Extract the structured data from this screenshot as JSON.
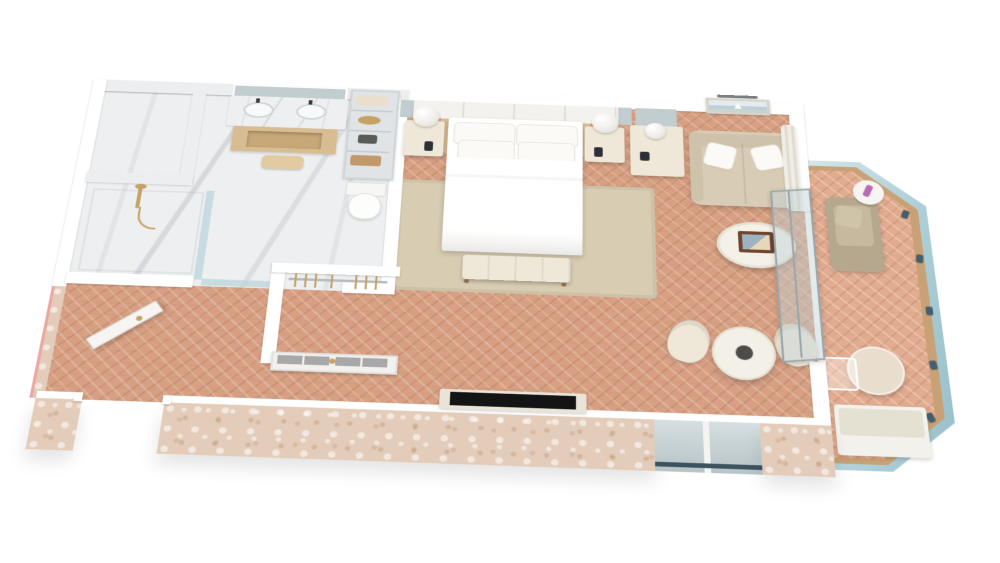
{
  "scene": {
    "type": "isometric-3d-floorplan-render",
    "description": "3D cutaway floor plan render of a hotel suite with marble bathroom, bedroom, lounge area and curved glass balcony",
    "background": "#ffffff",
    "rooms": [
      {
        "id": "bathroom",
        "name": "bathroom"
      },
      {
        "id": "walk-in-shower",
        "name": "walk-in shower"
      },
      {
        "id": "water-closet",
        "name": "water closet"
      },
      {
        "id": "wardrobe",
        "name": "wardrobe closet"
      },
      {
        "id": "entry-hall",
        "name": "entry hallway"
      },
      {
        "id": "bedroom",
        "name": "bedroom"
      },
      {
        "id": "lounge",
        "name": "lounge area"
      },
      {
        "id": "balcony",
        "name": "balcony"
      }
    ],
    "furniture": [
      "king-bed",
      "pillows",
      "bed-bench",
      "nightstand",
      "globe-lamp",
      "area-rug",
      "double-vanity",
      "vanity-mirror",
      "linen-shelves",
      "toilet",
      "hand-shower",
      "wardrobe-doors",
      "tv",
      "desk-console",
      "desk-mirror",
      "loveseat-sofa",
      "seascape-artwork",
      "picture-light",
      "coffee-table",
      "dining-table",
      "tub-chair",
      "sliding-glass-door",
      "curtain",
      "balcony-armchair",
      "balcony-side-table",
      "balcony-marble-table",
      "balcony-settee",
      "glass-balustrade",
      "entry-door"
    ]
  },
  "palette": {
    "wood_floor": "#d7a083",
    "marble": "#edeff0",
    "travertine": "#e3ccb9",
    "wall_cap": "#ffffff",
    "rug": "#d8ccb2",
    "bed_white": "#ffffff",
    "cream": "#efe8d8",
    "sofa": "#d9ccb6",
    "sofa_back": "#cfc2ab",
    "armchair": "#b5a88e",
    "armchair_cushion": "#c6b99e",
    "gold": "#c5a265",
    "tan_wood": "#d9bd92",
    "tv_black": "#141414",
    "tv_sill": "#eae4d8",
    "mirror": "#c2cdd0",
    "glass": "#bad6dc",
    "glass_deep": "#8fb9c4",
    "handrail_wood": "#c8a276",
    "clamp_blue": "#44606e",
    "frosted_panel": "#a8a8a8",
    "art_sea": "#bdd0d9",
    "art_sky": "#e3ebee",
    "tray_brown": "#6e4630",
    "pink_accent": "#b96ab4",
    "cut_edge_pink": "#eba8a2",
    "settee": "#e4e1d2",
    "marble_table": "#e9ddcd",
    "centerpiece_dark": "#4c4c48"
  }
}
